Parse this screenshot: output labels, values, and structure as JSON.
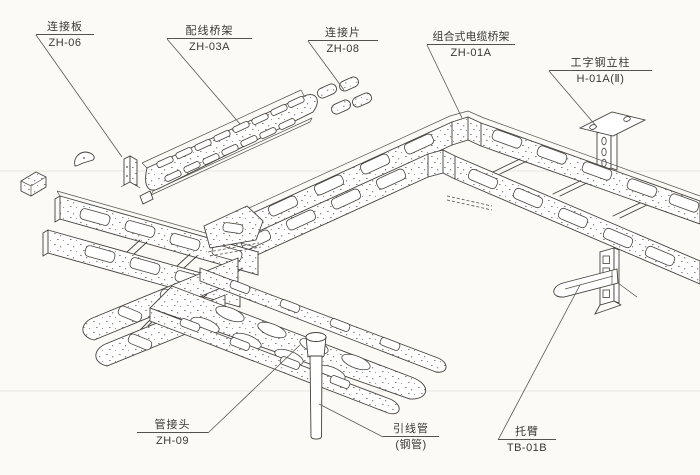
{
  "diagram": {
    "type": "isometric-assembly-drawing",
    "subject": "combined cable tray (bridge rack) installation",
    "colors": {
      "background": "#fbfaf7",
      "line": "#45413c",
      "label_text": "#3b3835"
    },
    "labels": [
      {
        "id": "connector-plate",
        "name": "连接板",
        "code": "ZH-06"
      },
      {
        "id": "wiring-tray",
        "name": "配线桥架",
        "code": "ZH-03A"
      },
      {
        "id": "connector-strip",
        "name": "连接片",
        "code": "ZH-08"
      },
      {
        "id": "combined-cable-tray",
        "name": "组合式电缆桥架",
        "code": "ZH-01A"
      },
      {
        "id": "i-beam-column",
        "name": "工字钢立柱",
        "code": "H-01A(Ⅱ)"
      },
      {
        "id": "pipe-joint",
        "name": "管接头",
        "code": "ZH-09"
      },
      {
        "id": "lead-pipe",
        "name": "引线管",
        "code": "(钢管)"
      },
      {
        "id": "cantilever-arm",
        "name": "托臂",
        "code": "TB-01B"
      }
    ]
  }
}
